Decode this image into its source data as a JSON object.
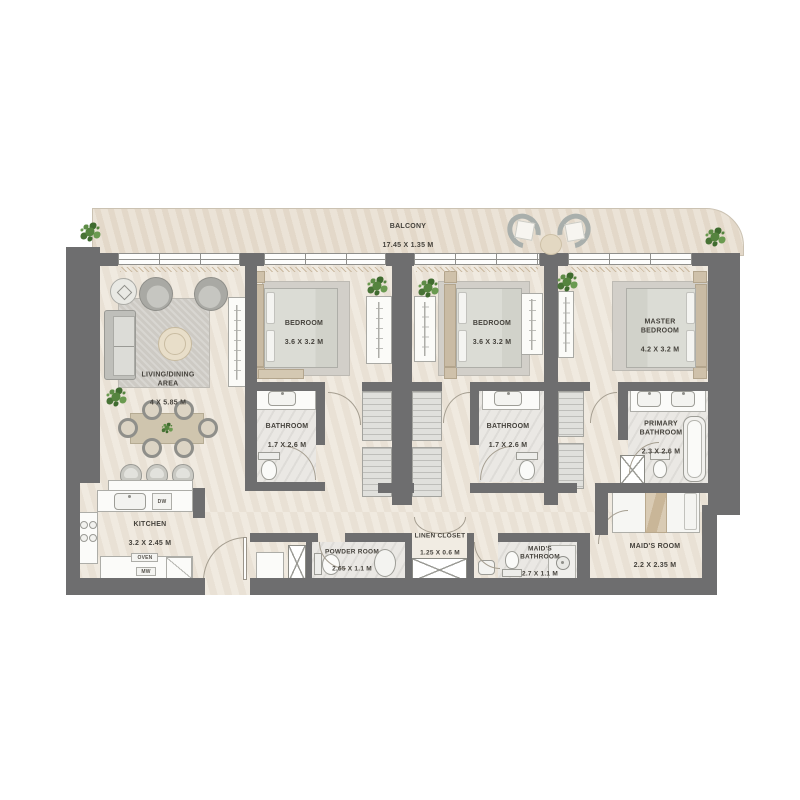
{
  "rooms": {
    "balcony": {
      "name": "BALCONY",
      "dims": "17.45 X 1.35 M"
    },
    "living": {
      "name": "LIVING/DINING\nAREA",
      "dims": "4 X 5.85 M"
    },
    "bedroom1": {
      "name": "BEDROOM",
      "dims": "3.6 X 3.2 M"
    },
    "bedroom2": {
      "name": "BEDROOM",
      "dims": "3.6 X 3.2 M"
    },
    "master": {
      "name": "MASTER\nBEDROOM",
      "dims": "4.2 X 3.2 M"
    },
    "bath1": {
      "name": "BATHROOM",
      "dims": "1.7 X 2.6 M"
    },
    "bath2": {
      "name": "BATHROOM",
      "dims": "1.7 X 2.6 M"
    },
    "primary_bath": {
      "name": "PRIMARY\nBATHROOM",
      "dims": "2.3 X 2.6 M"
    },
    "kitchen": {
      "name": "KITCHEN",
      "dims": "3.2 X 2.45 M"
    },
    "powder": {
      "name": "POWDER ROOM",
      "dims": "2.65 X 1.1 M"
    },
    "linen": {
      "name": "LINEN CLOSET",
      "dims": "1.25 X 0.6 M"
    },
    "maid_bath": {
      "name": "MAID'S\nBATHROOM",
      "dims": "2.7 X 1.1 M"
    },
    "maid_room": {
      "name": "MAID'S ROOM",
      "dims": "2.2 X 2.35 M"
    }
  },
  "kitchen_appliances": {
    "dw": "DW",
    "oven": "OVEN",
    "mw": "MW"
  },
  "colors": {
    "wall": "#6E6E6F",
    "interior_floor": "#EDE6DB",
    "balcony_floor": "#E7DDCE",
    "accent_tan": "#C9BBA4",
    "plant_green": "#55843F"
  }
}
